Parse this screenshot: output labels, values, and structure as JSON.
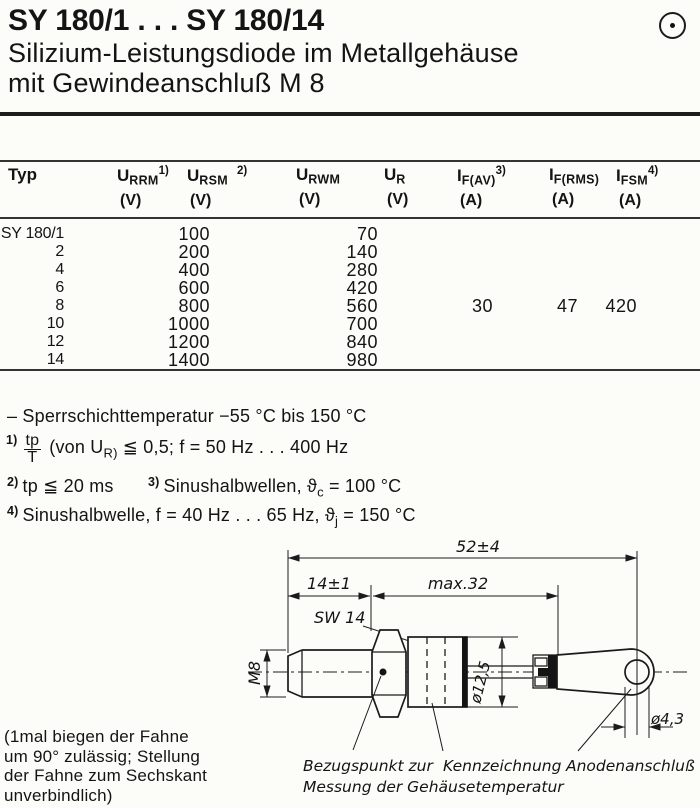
{
  "header": {
    "title": "SY 180/1 . . . SY 180/14",
    "subtitle_line1": "Silizium-Leistungsdiode im Metallgehäuse",
    "subtitle_line2": "mit Gewindeanschluß M 8",
    "corner_symbol": "circled-dot"
  },
  "table": {
    "columns": [
      {
        "label": "Typ",
        "sym": "",
        "sub": "",
        "sup": "",
        "unit": ""
      },
      {
        "label": "",
        "sym": "U",
        "sub": "RRM",
        "sup": "1)",
        "unit": "(V)"
      },
      {
        "label": "",
        "sym": "U",
        "sub": "RSM",
        "sup": "2)",
        "unit": "(V)"
      },
      {
        "label": "",
        "sym": "U",
        "sub": "RWM",
        "sup": "",
        "unit": "(V)"
      },
      {
        "label": "",
        "sym": "U",
        "sub": "R",
        "sup": "",
        "unit": "(V)"
      },
      {
        "label": "",
        "sym": "I",
        "sub": "F(AV)",
        "sup": "3)",
        "unit": "(A)"
      },
      {
        "label": "",
        "sym": "I",
        "sub": "F(RMS)",
        "sup": "",
        "unit": "(A)"
      },
      {
        "label": "",
        "sym": "I",
        "sub": "FSM",
        "sup": "4)",
        "unit": "(A)"
      }
    ],
    "rows": [
      [
        "SY 180/1",
        "100",
        "",
        "70",
        "",
        "",
        "",
        ""
      ],
      [
        "2",
        "200",
        "",
        "140",
        "",
        "",
        "",
        ""
      ],
      [
        "4",
        "400",
        "",
        "280",
        "",
        "",
        "",
        ""
      ],
      [
        "6",
        "600",
        "",
        "420",
        "",
        "",
        "",
        ""
      ],
      [
        "8",
        "800",
        "",
        "560",
        "",
        "30",
        "47",
        "420"
      ],
      [
        "10",
        "1000",
        "",
        "700",
        "",
        "",
        "",
        ""
      ],
      [
        "12",
        "1200",
        "",
        "840",
        "",
        "",
        "",
        ""
      ],
      [
        "14",
        "1400",
        "",
        "980",
        "",
        "",
        "",
        ""
      ]
    ]
  },
  "notes": {
    "temp": "– Sperrschichttemperatur −55 °C bis 150 °C",
    "n1_sup": "1)",
    "n1_num": "tp",
    "n1_den": "T",
    "n1_a": "(von U",
    "n1_a_sub": "R)",
    "n1_b": " ≦ 0,5;  f = 50 Hz . . . 400 Hz",
    "n2_sup": "2)",
    "n2_text": "tp ≦ 20 ms",
    "n3_sup": "3)",
    "n3_a": "Sinushalbwellen,  ",
    "n3_theta": "ϑ",
    "n3_sub": "c",
    "n3_b": " = 100 °C",
    "n4_sup": "4)",
    "n4_a": "Sinushalbwelle, f = 40 Hz . . . 65 Hz,  ",
    "n4_theta": "ϑ",
    "n4_sub": "j",
    "n4_b": "  = 150 °C"
  },
  "drawing": {
    "dim_52": "52±4",
    "dim_14": "14±1",
    "dim_32": "max.32",
    "sw14": "SW 14",
    "m8": "M8",
    "dia_125": "ø12,5",
    "dia_43": "ø4,3",
    "label_bezugspunkt_1": "Bezugspunkt zur",
    "label_bezugspunkt_2": "Messung der Gehäusetemperatur",
    "label_kennzeichnung": "Kennzeichnung",
    "label_anode": "Anodenanschluß"
  },
  "left_note": {
    "lines": [
      "(1mal biegen der Fahne",
      "um 90° zulässig; Stellung",
      "der Fahne zum Sechskant",
      "unverbindlich)"
    ]
  }
}
